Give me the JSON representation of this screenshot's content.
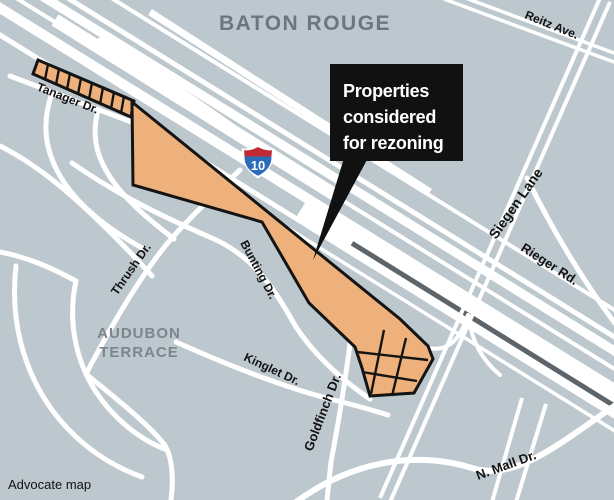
{
  "title": "BATON ROUGE",
  "credit": "Advocate map",
  "neighborhood": {
    "line1": "AUDUBON",
    "line2": "TERRACE"
  },
  "callout": {
    "line1": "Properties",
    "line2": "considered",
    "line3": "for rezoning"
  },
  "highway_shield": {
    "route": "10"
  },
  "streets": {
    "tanager": "Tanager Dr.",
    "reitz": "Reitz Ave.",
    "siegen": "Siegen Lane",
    "rieger": "Rieger Rd.",
    "thrush": "Thrush Dr.",
    "bunting": "Bunting Dr.",
    "kinglet": "Kinglet Dr.",
    "goldfinch": "Goldfinch Dr.",
    "nmall": "N. Mall Dr."
  },
  "colors": {
    "bg": "#bdc8ce",
    "road": "#ffffff",
    "median": "#5d646a",
    "parcel": "#efb17b",
    "outline": "#141414",
    "title": "#6d767e",
    "hood": "#7b858c",
    "label": "#131313",
    "callout_bg": "#111111",
    "callout_text": "#ffffff",
    "shield_red": "#c02b33",
    "shield_blue": "#2a6cb8"
  }
}
